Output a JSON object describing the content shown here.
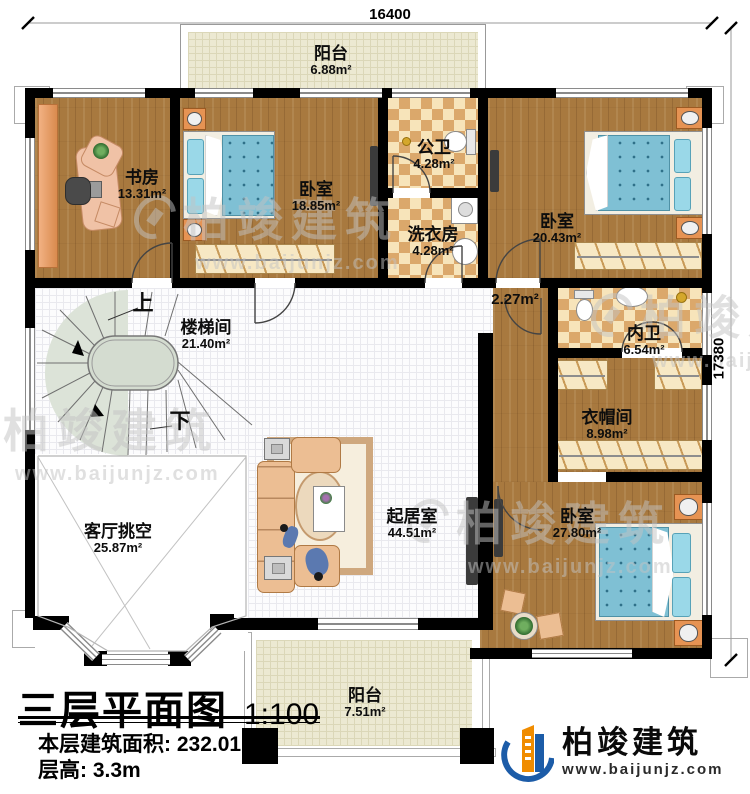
{
  "dimensions": {
    "width": "16400",
    "height": "17380"
  },
  "rooms": {
    "balcony_top": {
      "name": "阳台",
      "area": "6.88m²"
    },
    "study": {
      "name": "书房",
      "area": "13.31m²"
    },
    "bedroom1": {
      "name": "卧室",
      "area": "18.85m²"
    },
    "public_bath": {
      "name": "公卫",
      "area": "4.28m²"
    },
    "laundry": {
      "name": "洗衣房",
      "area": "4.28m²"
    },
    "bedroom2": {
      "name": "卧室",
      "area": "20.43m²"
    },
    "stairwell": {
      "name": "楼梯间",
      "area": "21.40m²"
    },
    "hall": {
      "area": "2.27m²"
    },
    "master_bath": {
      "name": "内卫",
      "area": "6.54m²"
    },
    "cloakroom": {
      "name": "衣帽间",
      "area": "8.98m²"
    },
    "living": {
      "name": "起居室",
      "area": "44.51m²"
    },
    "bedroom3": {
      "name": "卧室",
      "area": "27.80m²"
    },
    "void": {
      "name": "客厅挑空",
      "area": "25.87m²"
    },
    "balcony_bottom": {
      "name": "阳台",
      "area": "7.51m²"
    }
  },
  "stairs": {
    "up": "上",
    "down": "下"
  },
  "title_block": {
    "title": "三层平面图",
    "scale": "1:100",
    "floor_area_label": "本层建筑面积:",
    "floor_area_value": "232.01m²",
    "floor_height_label": "层高:",
    "floor_height_value": "3.3m"
  },
  "brand": {
    "name": "柏竣建筑",
    "url": "www.baijunjz.com"
  },
  "watermark": {
    "name": "柏竣建筑",
    "url": "www.baijunjz.com"
  },
  "colors": {
    "wall": "#000000",
    "wood": "#a8793f",
    "tile_dark": "#dba86b",
    "tile_light": "#f7e4ba",
    "bed_blue": "#7fc0d4",
    "sofa": "#ecbe93",
    "stair": "#dce3d8",
    "logo_blue": "#1c5ca8",
    "logo_orange": "#f08c00"
  }
}
